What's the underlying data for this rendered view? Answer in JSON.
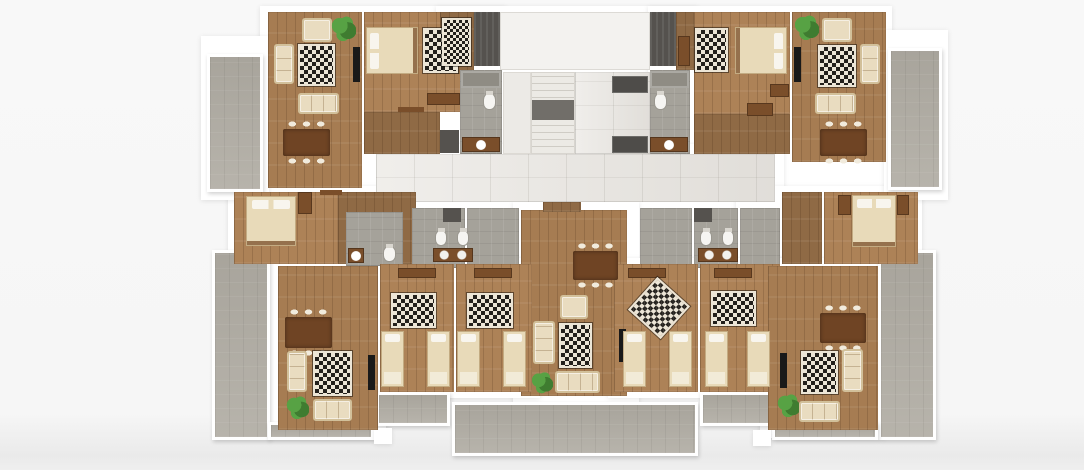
{
  "canvas": {
    "width": 1084,
    "height": 470,
    "background": "#f7f7f7"
  },
  "palette": {
    "wall": "#ffffff",
    "wood": "#a67c52",
    "woodl": "#ad8257",
    "woodd": "#8f6a45",
    "tile": "#e8e5e0",
    "bath": "#a5a29a",
    "bathd": "#8f8c84",
    "balcony": "#b1ada4",
    "landing": "#716e69",
    "dark": "#55524e",
    "elevc": "#4e4c49",
    "rugd": "#23201c",
    "rugl": "#ece5d6",
    "sofa": "#e9dcc0",
    "sofatrim": "#d2c09a",
    "brown": "#7a4e2a",
    "tablec": "#6f4424",
    "chair": "#f1ebdd",
    "tv": "#191919",
    "plant": "#57a244",
    "plantd": "#3f7c30",
    "bed": "#e8dab9",
    "pillow": "#f8f5ee",
    "toiletc": "#f6f5f2"
  },
  "rooms": [
    {
      "n": "plate-top-left",
      "f": "wall",
      "x": 260,
      "y": 6,
      "w": 246,
      "h": 198
    },
    {
      "n": "plate-core",
      "f": "wall",
      "x": 436,
      "y": 6,
      "w": 262,
      "h": 202
    },
    {
      "n": "plate-top-right",
      "f": "wall",
      "x": 648,
      "y": 6,
      "w": 244,
      "h": 198
    },
    {
      "n": "plate-corridor",
      "f": "wall",
      "x": 360,
      "y": 144,
      "w": 424,
      "h": 66
    },
    {
      "n": "plate-mid-left",
      "f": "wall",
      "x": 228,
      "y": 186,
      "w": 194,
      "h": 86
    },
    {
      "n": "plate-baths",
      "f": "wall",
      "x": 405,
      "y": 200,
      "w": 350,
      "h": 76
    },
    {
      "n": "plate-mid-right",
      "f": "wall",
      "x": 736,
      "y": 186,
      "w": 186,
      "h": 86
    },
    {
      "n": "plate-center",
      "f": "wall",
      "x": 513,
      "y": 202,
      "w": 126,
      "h": 204
    },
    {
      "n": "plate-bottom-left-living",
      "f": "wall",
      "x": 270,
      "y": 258,
      "w": 116,
      "h": 180
    },
    {
      "n": "plate-bottom-left-bedrooms",
      "f": "wall",
      "x": 370,
      "y": 258,
      "w": 170,
      "h": 140
    },
    {
      "n": "plate-bottom-right-bedrooms",
      "f": "wall",
      "x": 608,
      "y": 258,
      "w": 178,
      "h": 140
    },
    {
      "n": "plate-bottom-right-living",
      "f": "wall",
      "x": 760,
      "y": 258,
      "w": 126,
      "h": 180
    },
    {
      "n": "plate-balcony-left",
      "f": "wall",
      "x": 201,
      "y": 36,
      "w": 68,
      "h": 164
    },
    {
      "n": "plate-balcony-right",
      "f": "wall",
      "x": 884,
      "y": 30,
      "w": 64,
      "h": 170
    },
    {
      "n": "balcony-left",
      "f": "balcony",
      "x": 207,
      "y": 54,
      "w": 56,
      "h": 138
    },
    {
      "n": "balcony-right",
      "f": "balcony",
      "x": 888,
      "y": 48,
      "w": 54,
      "h": 142
    },
    {
      "n": "terrace-bottom-left",
      "f": "balcony",
      "x": 212,
      "y": 250,
      "w": 58,
      "h": 190
    },
    {
      "n": "terrace-strip-left",
      "f": "balcony",
      "x": 268,
      "y": 422,
      "w": 106,
      "h": 18
    },
    {
      "n": "balcony-bedrooms-left",
      "f": "balcony",
      "x": 376,
      "y": 392,
      "w": 74,
      "h": 34
    },
    {
      "n": "terrace-center",
      "f": "balcony",
      "x": 452,
      "y": 402,
      "w": 246,
      "h": 54
    },
    {
      "n": "balcony-bedrooms-right",
      "f": "balcony",
      "x": 700,
      "y": 392,
      "w": 74,
      "h": 34
    },
    {
      "n": "terrace-bottom-right",
      "f": "balcony",
      "x": 878,
      "y": 250,
      "w": 58,
      "h": 190
    },
    {
      "n": "terrace-strip-right",
      "f": "balcony",
      "x": 772,
      "y": 422,
      "w": 106,
      "h": 18
    },
    {
      "n": "terrace-pillar-left",
      "f": "wall",
      "x": 374,
      "y": 428,
      "w": 18,
      "h": 16
    },
    {
      "n": "terrace-pillar-right",
      "f": "wall",
      "x": 753,
      "y": 430,
      "w": 18,
      "h": 16
    },
    {
      "n": "living-room-top-left",
      "f": "wood",
      "x": 268,
      "y": 12,
      "w": 94,
      "h": 176
    },
    {
      "n": "bedroom-top-left",
      "f": "woodl",
      "x": 364,
      "y": 12,
      "w": 100,
      "h": 100
    },
    {
      "n": "hall-top-left",
      "f": "woodd",
      "x": 364,
      "y": 112,
      "w": 76,
      "h": 42
    },
    {
      "n": "entry-top-left",
      "f": "woodd",
      "x": 440,
      "y": 12,
      "w": 34,
      "h": 62
    },
    {
      "n": "bathroom-top-left",
      "f": "bath",
      "x": 460,
      "y": 70,
      "w": 42,
      "h": 84
    },
    {
      "n": "open-room",
      "f": "whitefloor",
      "x": 500,
      "y": 12,
      "w": 150,
      "h": 58
    },
    {
      "n": "stair-side",
      "f": "stairs",
      "x": 503,
      "y": 72,
      "w": 28,
      "h": 82
    },
    {
      "n": "staircase",
      "f": "stairsteps",
      "x": 531,
      "y": 72,
      "w": 44,
      "h": 82
    },
    {
      "n": "elevator-lobby",
      "f": "tile",
      "x": 575,
      "y": 72,
      "w": 75,
      "h": 82
    },
    {
      "n": "bathroom-top-right",
      "f": "bath",
      "x": 650,
      "y": 70,
      "w": 40,
      "h": 84
    },
    {
      "n": "entry-top-right",
      "f": "woodd",
      "x": 676,
      "y": 12,
      "w": 18,
      "h": 58
    },
    {
      "n": "bedroom-top-right",
      "f": "woodl",
      "x": 694,
      "y": 12,
      "w": 96,
      "h": 102
    },
    {
      "n": "hall-top-right",
      "f": "woodd",
      "x": 694,
      "y": 114,
      "w": 96,
      "h": 40
    },
    {
      "n": "living-room-top-right",
      "f": "wood",
      "x": 792,
      "y": 12,
      "w": 94,
      "h": 150
    },
    {
      "n": "corridor",
      "f": "tile",
      "x": 376,
      "y": 154,
      "w": 399,
      "h": 48
    },
    {
      "n": "bedroom-mid-left",
      "f": "woodl",
      "x": 234,
      "y": 192,
      "w": 104,
      "h": 72
    },
    {
      "n": "hall-mid-left",
      "f": "woodd",
      "x": 338,
      "y": 192,
      "w": 78,
      "h": 72
    },
    {
      "n": "bathroom-mid-left",
      "f": "bath",
      "x": 346,
      "y": 212,
      "w": 57,
      "h": 54
    },
    {
      "n": "bathroom-left-1",
      "f": "bath",
      "x": 412,
      "y": 208,
      "w": 53,
      "h": 60
    },
    {
      "n": "bathroom-left-2",
      "f": "bath",
      "x": 467,
      "y": 208,
      "w": 52,
      "h": 60
    },
    {
      "n": "living-room-center",
      "f": "wood",
      "x": 521,
      "y": 210,
      "w": 106,
      "h": 186
    },
    {
      "n": "entry-center",
      "f": "woodd",
      "x": 543,
      "y": 202,
      "w": 38,
      "h": 10
    },
    {
      "n": "bathroom-right-1",
      "f": "bath",
      "x": 640,
      "y": 208,
      "w": 52,
      "h": 60
    },
    {
      "n": "bathroom-right-2",
      "f": "bath",
      "x": 694,
      "y": 208,
      "w": 44,
      "h": 60
    },
    {
      "n": "hall-mid-right",
      "f": "bath",
      "x": 740,
      "y": 208,
      "w": 40,
      "h": 60
    },
    {
      "n": "hall-right",
      "f": "woodd",
      "x": 782,
      "y": 192,
      "w": 40,
      "h": 72
    },
    {
      "n": "bedroom-mid-right",
      "f": "woodl",
      "x": 824,
      "y": 192,
      "w": 94,
      "h": 72
    },
    {
      "n": "living-room-bottom-left",
      "f": "wood",
      "x": 278,
      "y": 266,
      "w": 100,
      "h": 164
    },
    {
      "n": "bedroom-bl-1",
      "f": "woodl",
      "x": 380,
      "y": 264,
      "w": 74,
      "h": 128
    },
    {
      "n": "bedroom-bl-2",
      "f": "woodl",
      "x": 456,
      "y": 264,
      "w": 76,
      "h": 128
    },
    {
      "n": "bedroom-br-1",
      "f": "woodl",
      "x": 614,
      "y": 264,
      "w": 84,
      "h": 128
    },
    {
      "n": "bedroom-br-2",
      "f": "woodl",
      "x": 700,
      "y": 264,
      "w": 80,
      "h": 128
    },
    {
      "n": "living-room-bottom-right",
      "f": "wood",
      "x": 768,
      "y": 266,
      "w": 110,
      "h": 164
    }
  ],
  "furniture": [
    {
      "n": "armchair-top-left",
      "t": "armchair",
      "x": 302,
      "y": 18,
      "w": 30,
      "h": 24
    },
    {
      "n": "plant-top-left",
      "t": "plant",
      "x": 331,
      "y": 15,
      "w": 25,
      "h": 27
    },
    {
      "n": "sofa-side-top-left",
      "t": "sofav",
      "x": 274,
      "y": 44,
      "w": 20,
      "h": 40
    },
    {
      "n": "rug-living-top-left",
      "t": "rug",
      "x": 298,
      "y": 44,
      "w": 37,
      "h": 42
    },
    {
      "n": "tv-top-left",
      "t": "tv",
      "x": 353,
      "y": 47,
      "w": 7,
      "h": 35
    },
    {
      "n": "sofa-top-left",
      "t": "sofah",
      "x": 298,
      "y": 93,
      "w": 41,
      "h": 21
    },
    {
      "n": "dining-table-top-left",
      "t": "table",
      "x": 283,
      "y": 129,
      "w": 47,
      "h": 27
    },
    {
      "n": "rug-bedroom-top-left",
      "t": "rug",
      "x": 423,
      "y": 28,
      "w": 35,
      "h": 45
    },
    {
      "n": "bed-top-left",
      "t": "bedh",
      "x": 366,
      "y": 27,
      "w": 52,
      "h": 47
    },
    {
      "n": "dresser-top-left",
      "t": "brown",
      "x": 427,
      "y": 93,
      "w": 33,
      "h": 12
    },
    {
      "n": "door-top-left",
      "t": "door",
      "x": 398,
      "y": 107,
      "w": 26,
      "h": 5
    },
    {
      "n": "rug-entry-top-left",
      "t": "rugs",
      "x": 442,
      "y": 18,
      "w": 29,
      "h": 48
    },
    {
      "n": "shower-top-left",
      "t": "shower",
      "x": 461,
      "y": 71,
      "w": 40,
      "h": 17
    },
    {
      "n": "toilet-top-left",
      "t": "toilet",
      "x": 483,
      "y": 93,
      "w": 13,
      "h": 17
    },
    {
      "n": "vanity-top-left",
      "t": "vanity1",
      "x": 462,
      "y": 137,
      "w": 38,
      "h": 15
    },
    {
      "n": "closet-top-left",
      "t": "panel",
      "x": 440,
      "y": 130,
      "w": 19,
      "h": 23
    },
    {
      "n": "shaft-left",
      "t": "shaft",
      "x": 474,
      "y": 12,
      "w": 26,
      "h": 54
    },
    {
      "n": "shaft-right",
      "t": "shaft",
      "x": 650,
      "y": 12,
      "w": 26,
      "h": 54
    },
    {
      "n": "stair-landing",
      "t": "landing",
      "x": 532,
      "y": 100,
      "w": 42,
      "h": 20
    },
    {
      "n": "elevator-top",
      "t": "elev",
      "x": 612,
      "y": 76,
      "w": 36,
      "h": 17
    },
    {
      "n": "elevator-bottom",
      "t": "elev",
      "x": 612,
      "y": 136,
      "w": 36,
      "h": 17
    },
    {
      "n": "shower-top-right",
      "t": "shower",
      "x": 650,
      "y": 71,
      "w": 39,
      "h": 17
    },
    {
      "n": "toilet-top-right",
      "t": "toilet",
      "x": 654,
      "y": 93,
      "w": 13,
      "h": 17
    },
    {
      "n": "vanity-top-right",
      "t": "vanity1",
      "x": 650,
      "y": 137,
      "w": 38,
      "h": 15
    },
    {
      "n": "wardrobe-entry-top-right",
      "t": "brown",
      "x": 678,
      "y": 36,
      "w": 12,
      "h": 30
    },
    {
      "n": "rug-bedroom-top-right",
      "t": "rug",
      "x": 695,
      "y": 28,
      "w": 33,
      "h": 44
    },
    {
      "n": "bed-top-right",
      "t": "bedhr",
      "x": 735,
      "y": 27,
      "w": 52,
      "h": 47
    },
    {
      "n": "dresser-top-right",
      "t": "brown",
      "x": 770,
      "y": 84,
      "w": 19,
      "h": 13
    },
    {
      "n": "hall-table-top-right",
      "t": "brown",
      "x": 747,
      "y": 103,
      "w": 26,
      "h": 13
    },
    {
      "n": "plant-top-right",
      "t": "plant",
      "x": 794,
      "y": 14,
      "w": 25,
      "h": 27
    },
    {
      "n": "armchair-top-right",
      "t": "armchair",
      "x": 822,
      "y": 18,
      "w": 30,
      "h": 24
    },
    {
      "n": "rug-living-top-right",
      "t": "rug",
      "x": 818,
      "y": 45,
      "w": 38,
      "h": 42
    },
    {
      "n": "sofa-side-top-right",
      "t": "sofav",
      "x": 860,
      "y": 44,
      "w": 20,
      "h": 40
    },
    {
      "n": "tv-top-right",
      "t": "tv",
      "x": 794,
      "y": 47,
      "w": 7,
      "h": 35
    },
    {
      "n": "sofa-top-right",
      "t": "sofah",
      "x": 815,
      "y": 93,
      "w": 41,
      "h": 21
    },
    {
      "n": "dining-table-top-right",
      "t": "table",
      "x": 820,
      "y": 129,
      "w": 47,
      "h": 27
    },
    {
      "n": "bed-mid-left",
      "t": "bedv",
      "x": 246,
      "y": 196,
      "w": 50,
      "h": 50
    },
    {
      "n": "wardrobe-mid-left",
      "t": "brown",
      "x": 298,
      "y": 192,
      "w": 14,
      "h": 22
    },
    {
      "n": "door-mid-left",
      "t": "door",
      "x": 320,
      "y": 190,
      "w": 22,
      "h": 5
    },
    {
      "n": "toilet-mid-left",
      "t": "toilet",
      "x": 383,
      "y": 246,
      "w": 13,
      "h": 16
    },
    {
      "n": "vanity-mid-left",
      "t": "vanity1",
      "x": 348,
      "y": 248,
      "w": 16,
      "h": 15
    },
    {
      "n": "closet-baths-left",
      "t": "panel",
      "x": 443,
      "y": 208,
      "w": 18,
      "h": 14
    },
    {
      "n": "toilet-left-1",
      "t": "toilet",
      "x": 435,
      "y": 230,
      "w": 12,
      "h": 16
    },
    {
      "n": "toilet-left-2",
      "t": "toilet",
      "x": 457,
      "y": 230,
      "w": 12,
      "h": 16
    },
    {
      "n": "vanity-left-double",
      "t": "vanity2",
      "x": 433,
      "y": 248,
      "w": 40,
      "h": 14
    },
    {
      "n": "closet-baths-right",
      "t": "panel",
      "x": 694,
      "y": 208,
      "w": 18,
      "h": 14
    },
    {
      "n": "toilet-right-1",
      "t": "toilet",
      "x": 700,
      "y": 230,
      "w": 12,
      "h": 16
    },
    {
      "n": "toilet-right-2",
      "t": "toilet",
      "x": 722,
      "y": 230,
      "w": 12,
      "h": 16
    },
    {
      "n": "vanity-right-double",
      "t": "vanity2",
      "x": 698,
      "y": 248,
      "w": 40,
      "h": 14
    },
    {
      "n": "dining-table-center",
      "t": "table",
      "x": 573,
      "y": 251,
      "w": 45,
      "h": 29
    },
    {
      "n": "armchair-center",
      "t": "armchair",
      "x": 560,
      "y": 295,
      "w": 28,
      "h": 24
    },
    {
      "n": "sofa-side-center",
      "t": "sofav",
      "x": 533,
      "y": 321,
      "w": 22,
      "h": 43
    },
    {
      "n": "rug-center",
      "t": "rug",
      "x": 559,
      "y": 323,
      "w": 33,
      "h": 45
    },
    {
      "n": "tv-center",
      "t": "tv",
      "x": 619,
      "y": 329,
      "w": 7,
      "h": 33
    },
    {
      "n": "plant-center",
      "t": "plant",
      "x": 531,
      "y": 371,
      "w": 22,
      "h": 23
    },
    {
      "n": "sofa-center",
      "t": "sofah",
      "x": 555,
      "y": 371,
      "w": 45,
      "h": 22
    },
    {
      "n": "dining-table-bottom-left",
      "t": "table",
      "x": 285,
      "y": 317,
      "w": 47,
      "h": 31
    },
    {
      "n": "rug-living-bottom-left",
      "t": "rug",
      "x": 313,
      "y": 351,
      "w": 39,
      "h": 45
    },
    {
      "n": "sofa-side-bottom-left",
      "t": "sofav",
      "x": 287,
      "y": 351,
      "w": 20,
      "h": 41
    },
    {
      "n": "tv-bottom-left",
      "t": "tv",
      "x": 368,
      "y": 355,
      "w": 7,
      "h": 35
    },
    {
      "n": "plant-bottom-left",
      "t": "plant",
      "x": 286,
      "y": 395,
      "w": 23,
      "h": 25
    },
    {
      "n": "sofa-bottom-left",
      "t": "sofah",
      "x": 313,
      "y": 399,
      "w": 39,
      "h": 22
    },
    {
      "n": "dresser-bl-1",
      "t": "brown",
      "x": 398,
      "y": 268,
      "w": 38,
      "h": 10
    },
    {
      "n": "rug-bl-1",
      "t": "rug",
      "x": 391,
      "y": 293,
      "w": 45,
      "h": 35
    },
    {
      "n": "bed-bl-1a",
      "t": "beds",
      "x": 381,
      "y": 331,
      "w": 23,
      "h": 56
    },
    {
      "n": "bed-bl-1b",
      "t": "beds",
      "x": 427,
      "y": 331,
      "w": 23,
      "h": 56
    },
    {
      "n": "dresser-bl-2",
      "t": "brown",
      "x": 474,
      "y": 268,
      "w": 38,
      "h": 10
    },
    {
      "n": "rug-bl-2",
      "t": "rug",
      "x": 467,
      "y": 293,
      "w": 46,
      "h": 35
    },
    {
      "n": "bed-bl-2a",
      "t": "beds",
      "x": 457,
      "y": 331,
      "w": 23,
      "h": 56
    },
    {
      "n": "bed-bl-2b",
      "t": "beds",
      "x": 503,
      "y": 331,
      "w": 23,
      "h": 56
    },
    {
      "n": "dresser-br-1",
      "t": "brown",
      "x": 628,
      "y": 268,
      "w": 38,
      "h": 10
    },
    {
      "n": "rug-br-1",
      "t": "rug",
      "x": 637,
      "y": 286,
      "w": 44,
      "h": 44,
      "r": 42
    },
    {
      "n": "bed-br-1a",
      "t": "beds",
      "x": 623,
      "y": 331,
      "w": 23,
      "h": 56
    },
    {
      "n": "bed-br-1b",
      "t": "beds",
      "x": 669,
      "y": 331,
      "w": 23,
      "h": 56
    },
    {
      "n": "dresser-br-2",
      "t": "brown",
      "x": 714,
      "y": 268,
      "w": 38,
      "h": 10
    },
    {
      "n": "rug-br-2",
      "t": "rug",
      "x": 711,
      "y": 291,
      "w": 45,
      "h": 35
    },
    {
      "n": "bed-br-2a",
      "t": "beds",
      "x": 705,
      "y": 331,
      "w": 23,
      "h": 56
    },
    {
      "n": "bed-br-2b",
      "t": "beds",
      "x": 747,
      "y": 331,
      "w": 23,
      "h": 56
    },
    {
      "n": "dining-table-bottom-right",
      "t": "table",
      "x": 820,
      "y": 313,
      "w": 46,
      "h": 30
    },
    {
      "n": "rug-living-bottom-right",
      "t": "rug",
      "x": 801,
      "y": 351,
      "w": 37,
      "h": 43
    },
    {
      "n": "sofa-side-bottom-right",
      "t": "sofav",
      "x": 842,
      "y": 349,
      "w": 21,
      "h": 43
    },
    {
      "n": "tv-bottom-right",
      "t": "tv",
      "x": 780,
      "y": 353,
      "w": 7,
      "h": 35
    },
    {
      "n": "plant-bottom-right",
      "t": "plant",
      "x": 777,
      "y": 393,
      "w": 23,
      "h": 25
    },
    {
      "n": "sofa-bottom-right",
      "t": "sofah",
      "x": 799,
      "y": 401,
      "w": 41,
      "h": 21
    },
    {
      "n": "nightstand-mid-right-1",
      "t": "brown",
      "x": 838,
      "y": 195,
      "w": 13,
      "h": 20
    },
    {
      "n": "bed-mid-right",
      "t": "bedv",
      "x": 852,
      "y": 195,
      "w": 44,
      "h": 52
    },
    {
      "n": "nightstand-mid-right-2",
      "t": "brown",
      "x": 897,
      "y": 195,
      "w": 12,
      "h": 20
    }
  ]
}
